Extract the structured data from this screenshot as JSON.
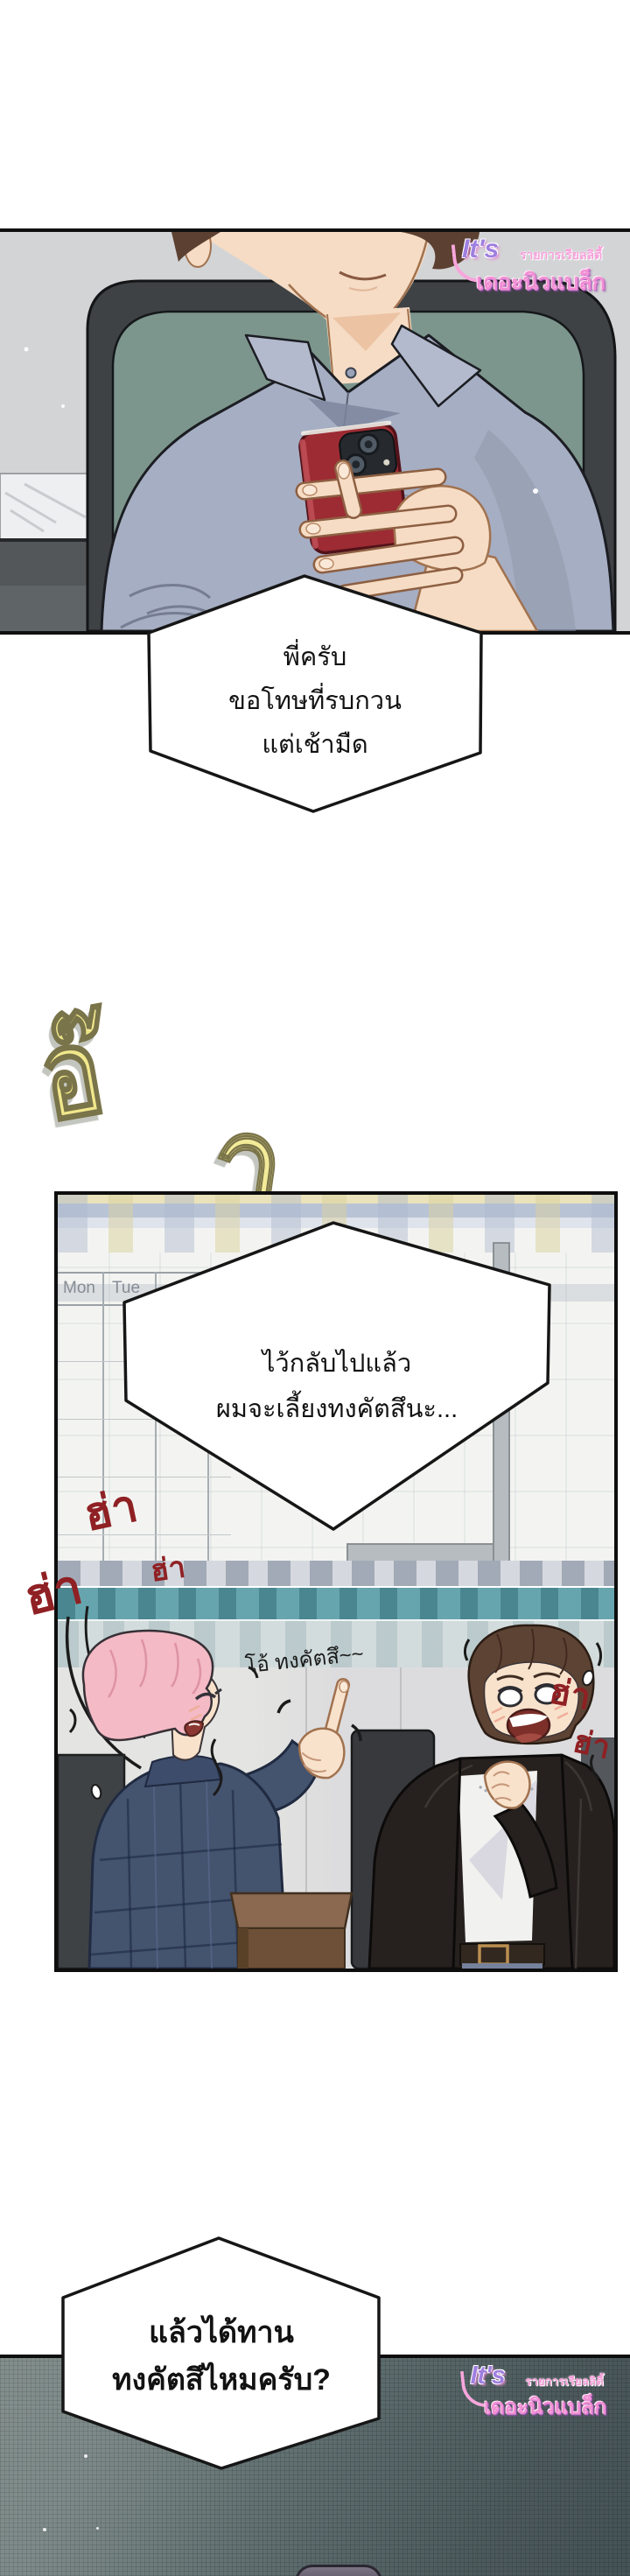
{
  "watermark": {
    "its": "It's",
    "subtitle": "รายการเรียลลิตี้",
    "title": "เดอะนิวแบล็ก"
  },
  "bubble1": {
    "line1": "พี่ครับ",
    "line2": "ขอโทษที่รบกวน",
    "line3": "แต่เช้ามืด"
  },
  "bubble2": {
    "line1": "ไว้กลับไปแล้ว",
    "line2": "ผมจะเลี้ยงทงคัตสึนะ..."
  },
  "bubble3": {
    "line1": "แล้วได้ทาน",
    "line2": "ทงคัตสึไหมครับ?"
  },
  "sfx": {
    "laugh_yellow": {
      "full": "อ๊ากกก!!",
      "g1": "อ๊",
      "g2": "า",
      "g3": "ก",
      "g4": "ก",
      "g5": "ก",
      "g6": "!!"
    },
    "laugh_red": {
      "r1": "ฮ่า",
      "r2": "ฮ่า",
      "r3": "ฮ่า",
      "r4": "ฮ่า",
      "r5": "ฮ่า"
    },
    "mutter": "โอ้ ทงคัตสึ~~"
  },
  "calendar": {
    "day1": "Mon",
    "day2": "Tue"
  },
  "colors": {
    "sfx_yellow": "#f4eca0",
    "sfx_red": "#8f2023",
    "watermark_pink": "#f18fd3",
    "watermark_purple": "#9f7fe0",
    "teal_band": "#67a5ae",
    "phone_red": "#9d2b33",
    "panel3_dark": "#5b6a6e"
  }
}
